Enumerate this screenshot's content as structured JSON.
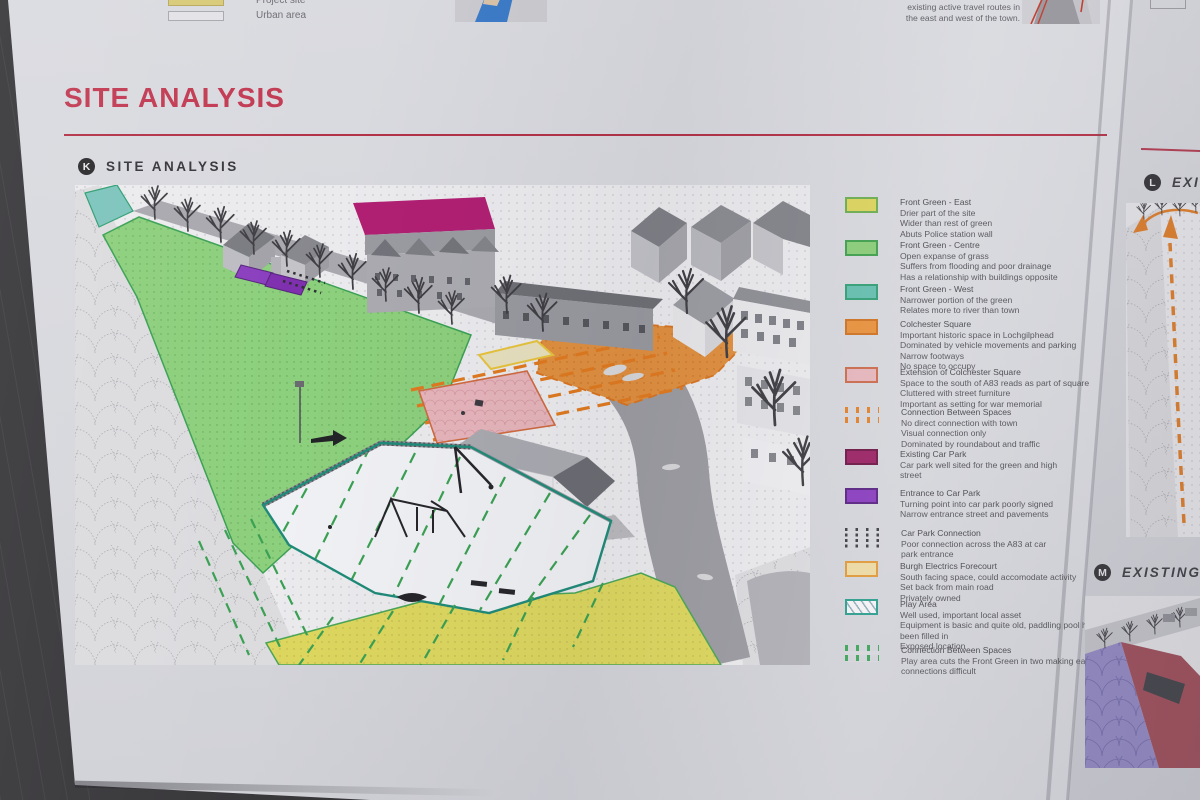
{
  "palette": {
    "board_grey": "#d6d7dc",
    "frame_dark": "#343336",
    "title_red": "#c23a52",
    "rule_red": "#b23248",
    "marker_black": "#2b2b2e",
    "front_green_east_yellow": "#dcd45e",
    "front_green_centre_green": "#8ccd7a",
    "front_green_west_teal": "#66bfb0",
    "colchester_square_orange": "#e8923e",
    "extension_pink": "#e6b6bd",
    "connection_orange_dash": "#e0832e",
    "existing_car_park_magenta": "#9b2566",
    "entrance_car_park_purple": "#8a3fbe",
    "car_park_connection_dark_dash": "#3f3f47",
    "burgh_electrics_cream": "#ecd9a4",
    "play_area_teal_border": "#2e9e8e",
    "connection_green_dash": "#3fa45c"
  },
  "top_strip": {
    "mini_legend": {
      "items": [
        {
          "label": "Project site"
        },
        {
          "label": "Urban area"
        }
      ]
    },
    "caption_lines": [
      "there is no link between",
      "existing active travel routes in",
      "the east and west of the town."
    ]
  },
  "header": {
    "title": "SITE ANALYSIS"
  },
  "section_k": {
    "marker": "K",
    "title": "SITE ANALYSIS"
  },
  "section_l": {
    "marker": "L",
    "title": "EXIS"
  },
  "section_m": {
    "marker": "M",
    "title": "EXISTING F"
  },
  "legend": {
    "items": [
      {
        "title": "Front Green - East",
        "lines": [
          "Drier part of the site",
          "Wider than rest of green",
          "Abuts Police station wall"
        ]
      },
      {
        "title": "Front Green - Centre",
        "lines": [
          "Open expanse of grass",
          "Suffers from flooding and poor drainage",
          "Has a relationship with buildings opposite"
        ]
      },
      {
        "title": "Front Green - West",
        "lines": [
          "Narrower portion of the green",
          "Relates more to river than town"
        ]
      },
      {
        "title": "Colchester Square",
        "lines": [
          "Important historic space in Lochgilphead",
          "Dominated by vehicle movements and parking",
          "Narrow footways",
          "No space to occupy"
        ]
      },
      {
        "title": "Extension of Colchester Square",
        "lines": [
          "Space to the south of A83 reads as part of square",
          "Cluttered with street furniture",
          "Important as setting for war memorial"
        ]
      },
      {
        "title": "Connection Between Spaces",
        "lines": [
          "No direct connection with town",
          "Visual connection only",
          "Dominated by roundabout and traffic"
        ]
      },
      {
        "title": "Existing Car Park",
        "lines": [
          "Car park well sited for the green and high",
          "street"
        ]
      },
      {
        "title": "Entrance to Car Park",
        "lines": [
          "Turning point into car park poorly signed",
          "Narrow entrance street and pavements"
        ]
      },
      {
        "title": "Car Park Connection",
        "lines": [
          "Poor connection across the A83 at car",
          "park entrance"
        ]
      },
      {
        "title": "Burgh Electrics Forecourt",
        "lines": [
          "South facing space, could accomodate activity",
          "Set back from main road",
          "Privately owned"
        ]
      },
      {
        "title": "Play Area",
        "lines": [
          "Well used, important local asset",
          "Equipment is basic and quite old, paddling pool has",
          "been filled in",
          "Exposed location"
        ]
      },
      {
        "title": "Connection Between Spaces",
        "lines": [
          "Play area cuts the Front Green in two making east/west",
          "connections difficult"
        ]
      }
    ]
  }
}
